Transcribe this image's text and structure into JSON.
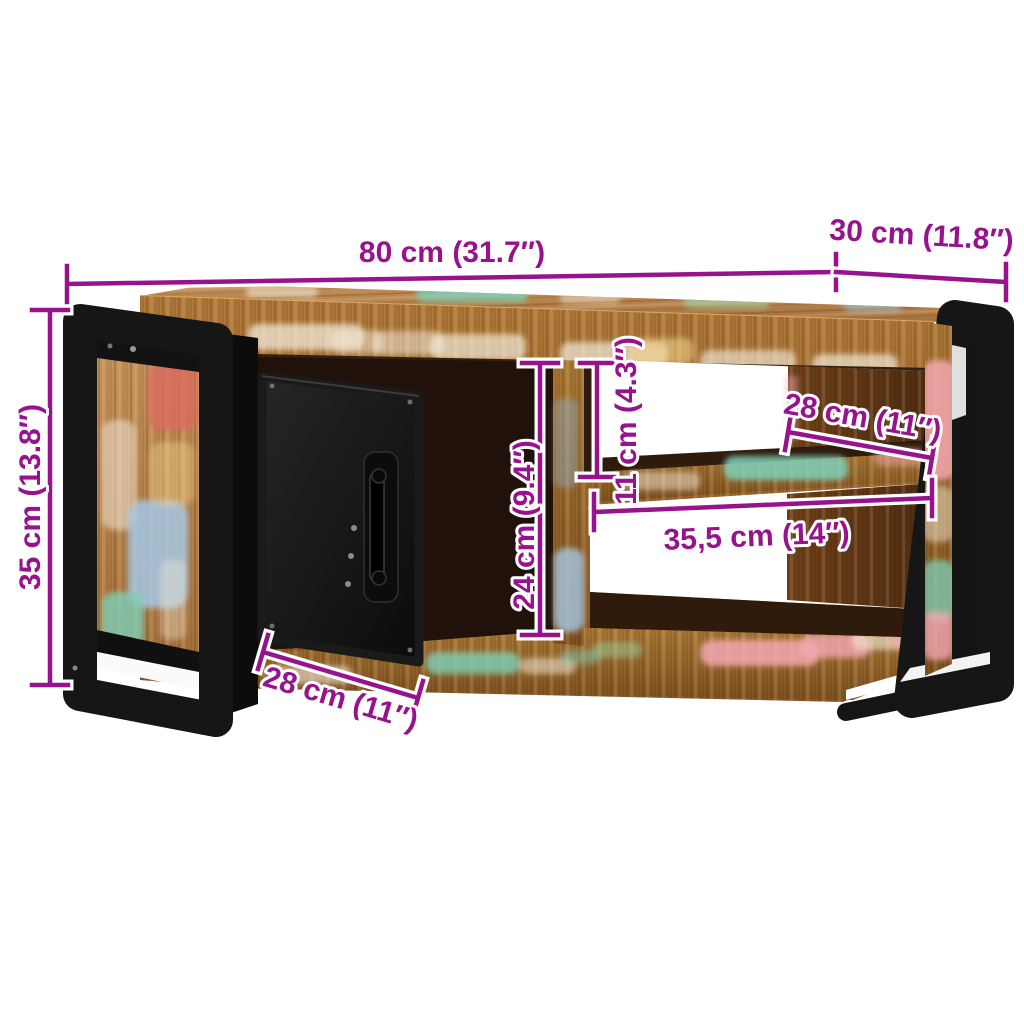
{
  "product": {
    "subject": "tv-cabinet-dimension-diagram"
  },
  "colors": {
    "background": "#FFFFFF",
    "dimension_accent": "#97138D",
    "metal": "#161616",
    "wood": "#A9713A"
  },
  "dimensions": {
    "overall_width": {
      "label": "80 cm (31.7″)"
    },
    "overall_depth": {
      "label": "30 cm (11.8″)"
    },
    "overall_height": {
      "label": "35 cm (13.8″)"
    },
    "door_opening_height": {
      "label": "24 cm (9.4″)"
    },
    "upper_compartment_height": {
      "label": "11 cm (4.3″)"
    },
    "upper_compartment_width": {
      "label": "28 cm (11″)"
    },
    "lower_compartment_width": {
      "label": "35,5 cm (14″)"
    },
    "door_width": {
      "label": "28 cm (11″)"
    }
  }
}
